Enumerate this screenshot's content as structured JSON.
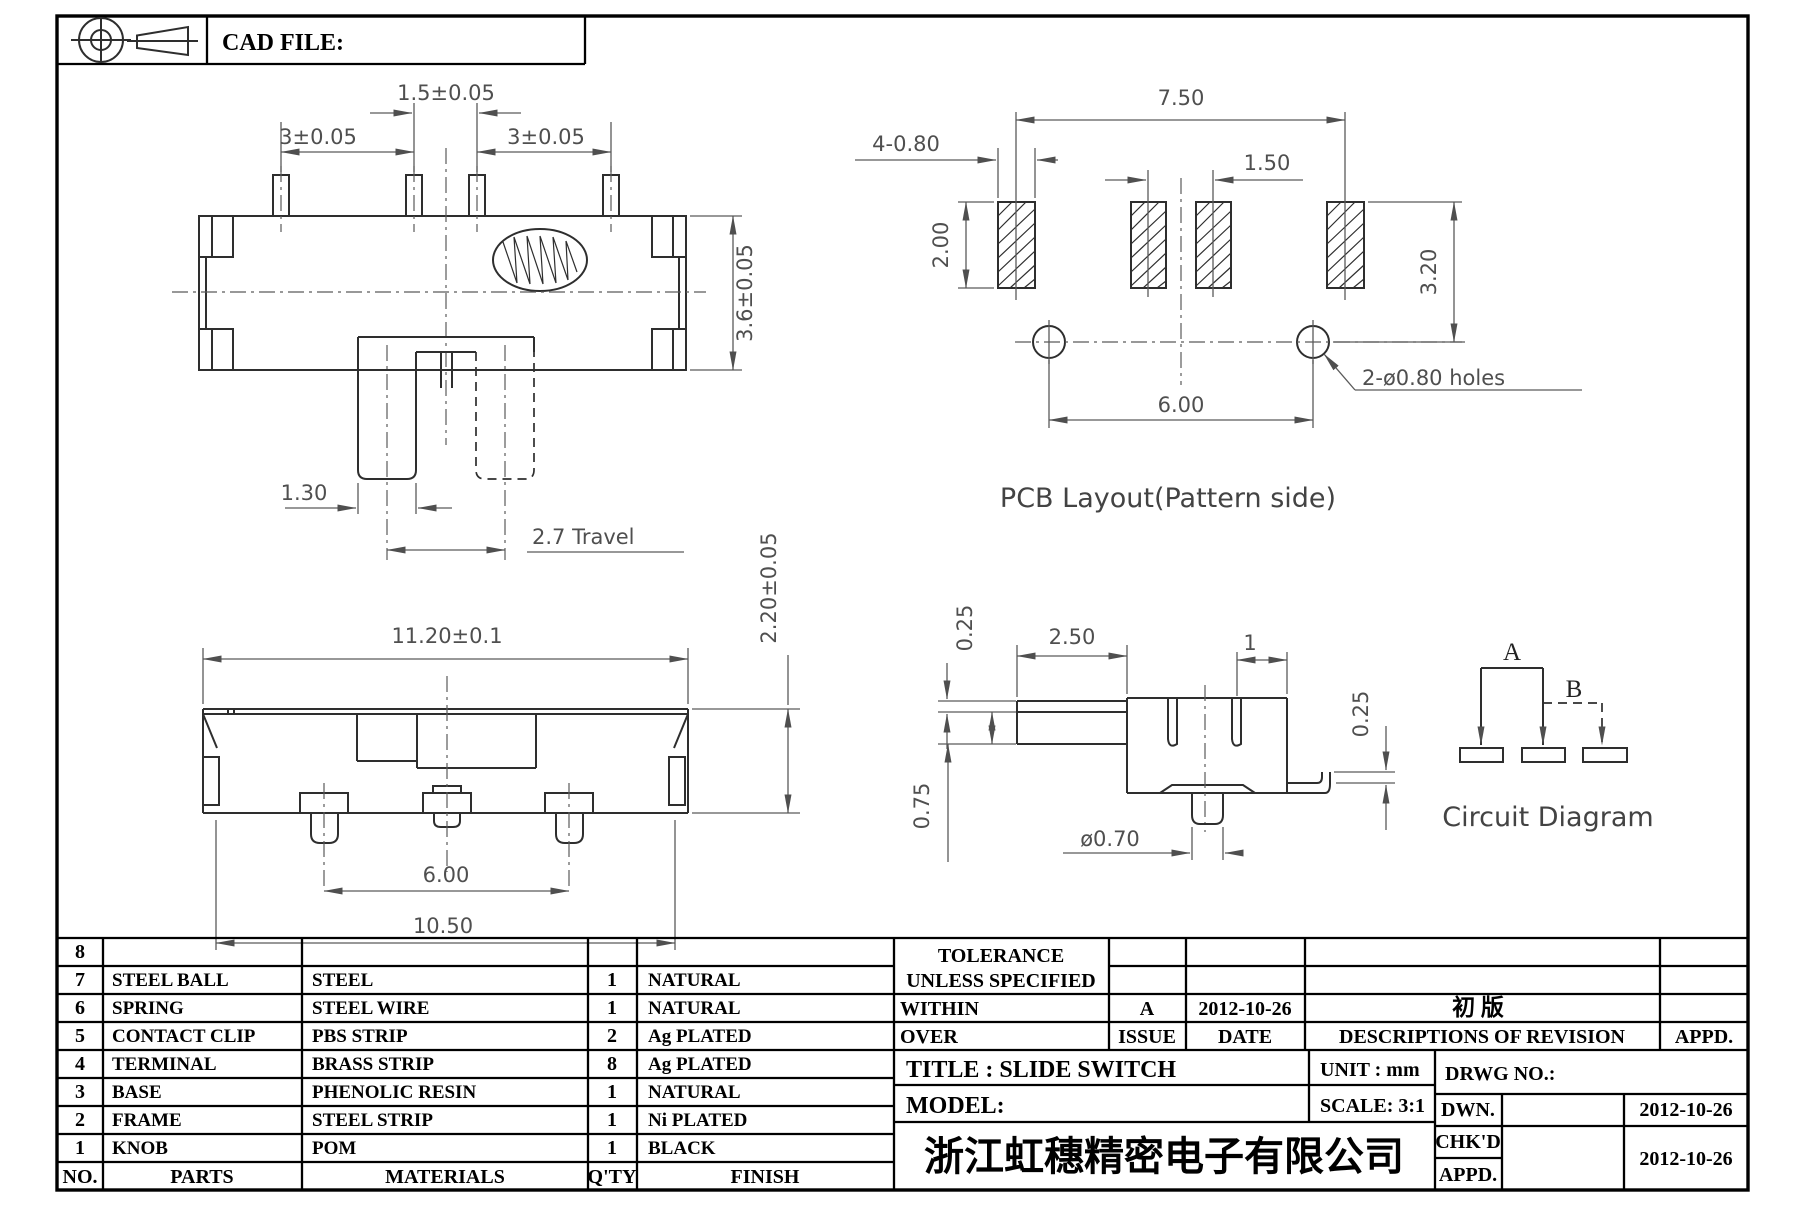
{
  "sheet": {
    "cad_file_label": "CAD FILE:"
  },
  "views": {
    "top": {
      "pitch_center": "1.5±0.05",
      "pitch_left": "3±0.05",
      "pitch_right": "3±0.05",
      "height": "3.6±0.05",
      "knob_width": "1.30",
      "travel": "2.7  Travel"
    },
    "pcb": {
      "title": "PCB  Layout(Pattern  side)",
      "span": "7.50",
      "pitch": "1.50",
      "pad": "4-0.80",
      "pad_height": "2.00",
      "hole_offset": "3.20",
      "hole_span": "6.00",
      "holes_note": "2-ø0.80  holes"
    },
    "front": {
      "width": "11.20±0.1",
      "pitch": "6.00",
      "base": "10.50",
      "height": "2.20±0.05"
    },
    "side": {
      "plate": "0.25",
      "arm": "2.50",
      "slot": "1",
      "tip": "0.25",
      "arm_height": "0.75",
      "pin": "ø0.70"
    },
    "circuit": {
      "title": "Circuit  Diagram",
      "pos_a": "A",
      "pos_b": "B"
    }
  },
  "parts_table": {
    "headers": {
      "no": "NO.",
      "parts": "PARTS",
      "materials": "MATERIALS",
      "qty": "Q'TY",
      "finish": "FINISH"
    },
    "rows": [
      {
        "no": "8",
        "parts": "",
        "materials": "",
        "qty": "",
        "finish": ""
      },
      {
        "no": "7",
        "parts": "STEEL BALL",
        "materials": "STEEL",
        "qty": "1",
        "finish": "NATURAL"
      },
      {
        "no": "6",
        "parts": "SPRING",
        "materials": "STEEL WIRE",
        "qty": "1",
        "finish": "NATURAL"
      },
      {
        "no": "5",
        "parts": "CONTACT CLIP",
        "materials": "PBS STRIP",
        "qty": "2",
        "finish": "Ag PLATED"
      },
      {
        "no": "4",
        "parts": "TERMINAL",
        "materials": "BRASS STRIP",
        "qty": "8",
        "finish": "Ag PLATED"
      },
      {
        "no": "3",
        "parts": "BASE",
        "materials": "PHENOLIC RESIN",
        "qty": "1",
        "finish": "NATURAL"
      },
      {
        "no": "2",
        "parts": "FRAME",
        "materials": "STEEL STRIP",
        "qty": "1",
        "finish": "Ni PLATED"
      },
      {
        "no": "1",
        "parts": "KNOB",
        "materials": "POM",
        "qty": "1",
        "finish": "BLACK"
      }
    ]
  },
  "title_block": {
    "tolerance_1": "TOLERANCE",
    "tolerance_2": "UNLESS   SPECIFIED",
    "within": "WITHIN",
    "over": "OVER",
    "issue_value": "A",
    "date_value": "2012-10-26",
    "revision_value": "初  版",
    "issue_label": "ISSUE",
    "date_label": "DATE",
    "descriptions_label": "DESCRIPTIONS  OF  REVISION",
    "appd_label": "APPD.",
    "title": "TITLE : SLIDE  SWITCH",
    "unit": "UNIT :   mm",
    "drwg_no": "DRWG  NO.:",
    "model": "MODEL:",
    "scale": "SCALE:   3:1",
    "dwn_label": "DWN.",
    "chkd_label": "CHK'D",
    "appd2_label": "APPD.",
    "dwn_date": "2012-10-26",
    "chk_date": "2012-10-26",
    "company": "浙江虹穗精密电子有限公司"
  }
}
